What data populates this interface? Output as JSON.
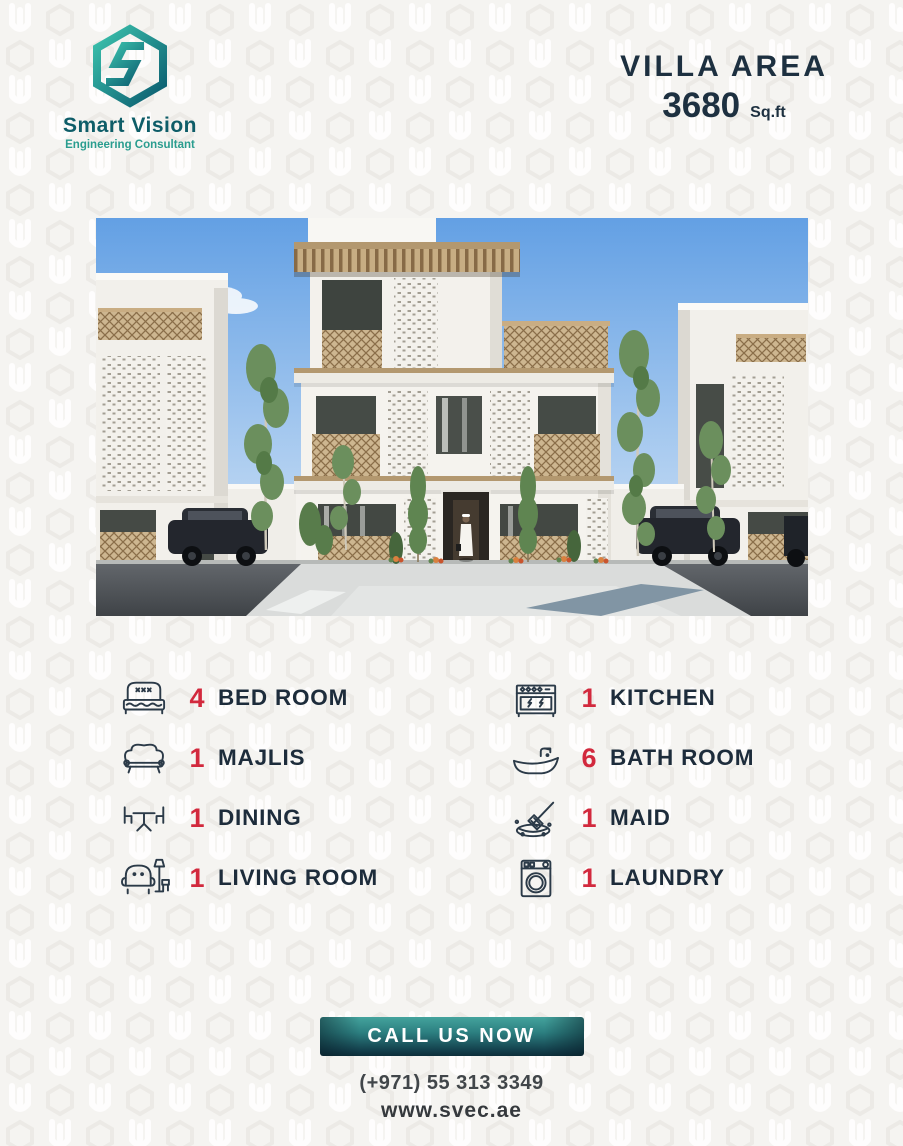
{
  "brand": {
    "name": "Smart Vision",
    "tagline": "Engineering Consultant"
  },
  "header": {
    "title": "VILLA AREA",
    "area_value": "3680",
    "area_unit": "Sq.ft"
  },
  "features": [
    {
      "count": "4",
      "label": "BED ROOM",
      "icon": "bed-icon"
    },
    {
      "count": "1",
      "label": "MAJLIS",
      "icon": "sofa-icon"
    },
    {
      "count": "1",
      "label": "DINING",
      "icon": "dining-table-icon"
    },
    {
      "count": "1",
      "label": "LIVING ROOM",
      "icon": "armchair-lamp-icon"
    },
    {
      "count": "1",
      "label": "KITCHEN",
      "icon": "stove-icon"
    },
    {
      "count": "6",
      "label": "BATH ROOM",
      "icon": "bathtub-icon"
    },
    {
      "count": "1",
      "label": "MAID",
      "icon": "cleaning-icon"
    },
    {
      "count": "1",
      "label": "LAUNDRY",
      "icon": "washing-machine-icon"
    }
  ],
  "cta": {
    "label": "CALL US NOW",
    "phone": "(+971) 55 313 3349",
    "website": "www.svec.ae"
  },
  "colors": {
    "accent_red": "#d2293d",
    "navy_text": "#1d2c3b",
    "teal_brand": "#2a9d8f",
    "teal_brand_dark": "#0e5d68",
    "button_gradient_top": "#44a39d",
    "button_gradient_bottom": "#0d2e3a",
    "background": "#f5f4f1"
  }
}
